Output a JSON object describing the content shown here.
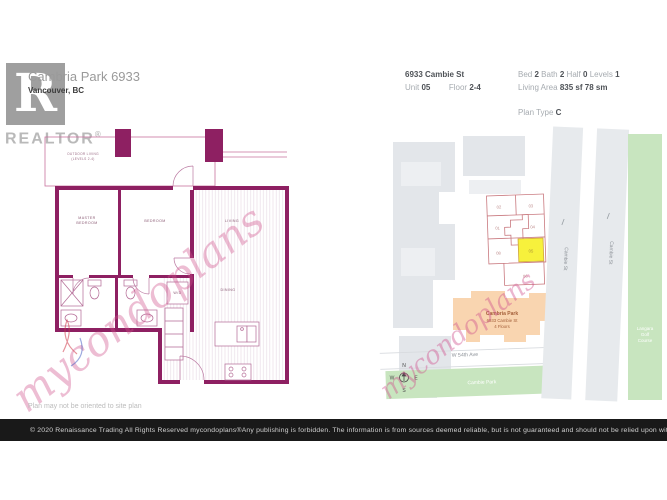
{
  "brand": {
    "r_letter": "R",
    "realtor": "REALTOR",
    "registered": "®"
  },
  "header": {
    "title": "Cambria Park 6933",
    "city": "Vancouver, BC",
    "address": "6933 Cambie St",
    "labels": {
      "unit": "Unit",
      "floor": "Floor",
      "bed": "Bed",
      "bath": "Bath",
      "half": "Half",
      "levels": "Levels",
      "living_area": "Living Area",
      "plan_type": "Plan Type"
    },
    "values": {
      "unit": "05",
      "floor": "2-4",
      "bed": "2",
      "bath": "2",
      "half": "0",
      "levels": "1",
      "living_area_sf": "835 sf",
      "living_area_sm": "78 sm",
      "plan_type": "C"
    }
  },
  "floor_plan": {
    "labels": {
      "outdoor_living_1": "OUTDOOR LIVING",
      "outdoor_living_2": "(LEVELS 2-4)",
      "master_1": "MASTER",
      "master_2": "BEDROOM",
      "bedroom": "BEDROOM",
      "living": "LIVING",
      "dining": "DINING",
      "wd": "W/D"
    },
    "watermark": "mycondoplans"
  },
  "site_plan": {
    "units": {
      "u02": "02",
      "u03": "03",
      "u01": "01",
      "u04": "04",
      "u08": "08",
      "u05": "05",
      "u06": "06"
    },
    "building": {
      "name": "Cambria Park",
      "address": "6933 Cambie St",
      "floors": "4 Floors"
    },
    "streets": {
      "w54th": "W 54th Ave",
      "cambie_a": "Cambie St",
      "cambie_b": "Cambie St"
    },
    "parks": {
      "cambie_park": "Cambie Park",
      "langara_1": "Langara",
      "langara_2": "Golf",
      "langara_3": "Course"
    },
    "compass": {
      "n": "N",
      "e": "E",
      "s": "S",
      "w": "W"
    },
    "watermark": "mycondoplans"
  },
  "note": "Plan may not be oriented to site plan",
  "footer": {
    "left": "© 2020  Renaissance Trading  All Rights Reserved  mycondoplans®",
    "right": "Any publishing is forbidden.  The information is from sources deemed reliable, but is not guaranteed and should not be relied upon without independent verification."
  },
  "colors": {
    "wall_magenta": "#8e2062",
    "watermark_pink": "#cf528c",
    "site_gray": "#e3e6ea",
    "park_green": "#c8e5bf",
    "building_orange": "#f9d5b0",
    "highlight_yellow": "#f7f13c",
    "footer_bg": "#191919"
  }
}
